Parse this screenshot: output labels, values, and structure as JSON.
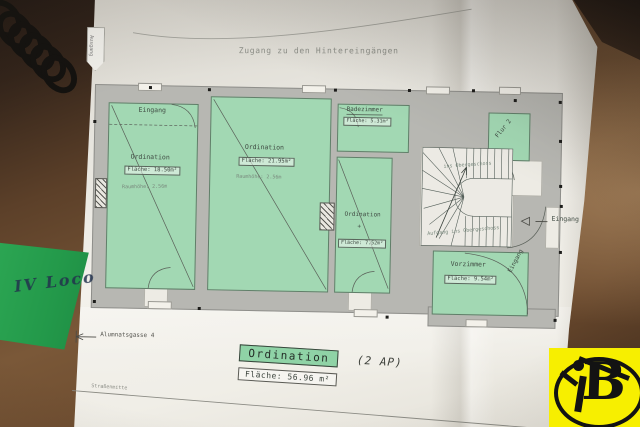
{
  "photo": {
    "sticky_note_text": "IV Loco"
  },
  "plan": {
    "access_label": "Zugang zu den Hintereingängen",
    "exit_arrow_label": "Ausgang",
    "street_name": "Alumnatsgasse 4",
    "street_line_label": "Straßenmitte",
    "rooms": {
      "room1": {
        "entrance": "Eingang",
        "name": "Ordination",
        "area": "Fläche: 18.50m²",
        "height": "Raumhöhe: 2.56m"
      },
      "room2": {
        "name": "Ordination",
        "area": "Fläche: 21.95m²",
        "height": "Raumhöhe: 2.56m"
      },
      "bath": {
        "name": "Badezimmer",
        "area": "Fläche: 5.31m²"
      },
      "room3": {
        "name": "Ordination",
        "plus": "+",
        "area": "Fläche: 7.52m²"
      },
      "flur": {
        "name": "Flur 2"
      },
      "vorzimmer": {
        "name": "Vorzimmer",
        "area": "Fläche: 9.54m²",
        "entrance": "Eingang"
      }
    },
    "stairs": {
      "upper_label": "ins Obergeschoss",
      "lower_label": "Aufgang ins Obergeschoss"
    },
    "entrance_right": "Eingang",
    "legend": {
      "room_type": "Ordination",
      "suffix": "(2 AP)",
      "total_area": "Fläche: 56.96 m²"
    }
  },
  "logo": {
    "letter": "B"
  },
  "colors": {
    "room_green": "#a2d8b3",
    "wall_grey": "#b7b7b2",
    "note_green": "#23994a",
    "logo_yellow": "#f7ef00",
    "legend_green": "#8fd3a6"
  }
}
